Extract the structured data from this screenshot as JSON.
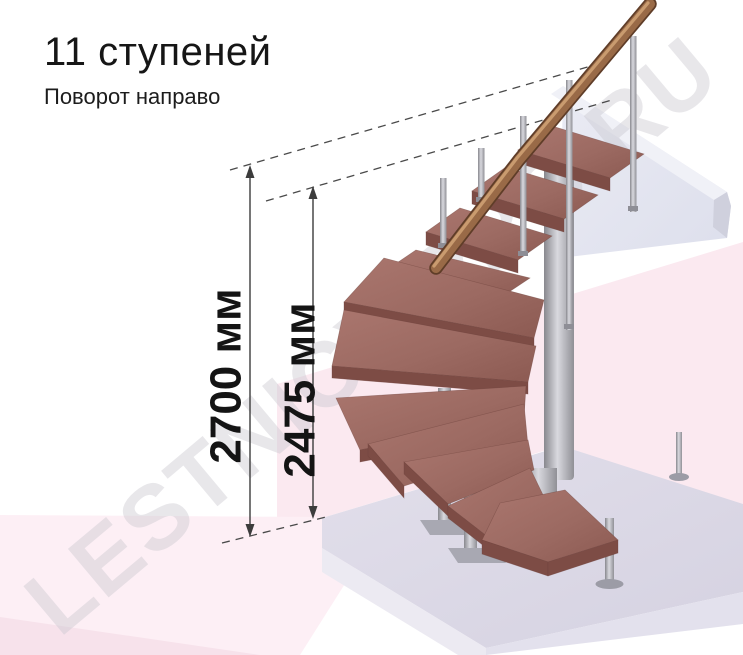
{
  "header": {
    "title": "11 ступеней",
    "subtitle": "Поворот направо"
  },
  "dimension_annotations": {
    "total_rise": "2700 мм",
    "rise_to_top_step": "2475 мм"
  },
  "watermark": {
    "text": "LESTNICY-PRO.RU"
  },
  "figure": {
    "steps_count": "11",
    "turn_direction": "направо"
  },
  "colors": {
    "wall_pink": "#fbe9f0",
    "floor_pink": "#fdeff5",
    "floor_front_pink": "#f7e2eb",
    "platform_top": "#dcd9e5",
    "platform_front_left": "#eceaf2",
    "platform_front_right": "#e3e1ed",
    "slab_front": "#e4e5f0",
    "slab_top": "#f0f1f7",
    "slab_end": "#cfd0dd",
    "tread_front": "#7d4c45",
    "dimension_line": "#3c3c3c",
    "dashed_line": "#4a4a4a",
    "text": "#141414"
  }
}
